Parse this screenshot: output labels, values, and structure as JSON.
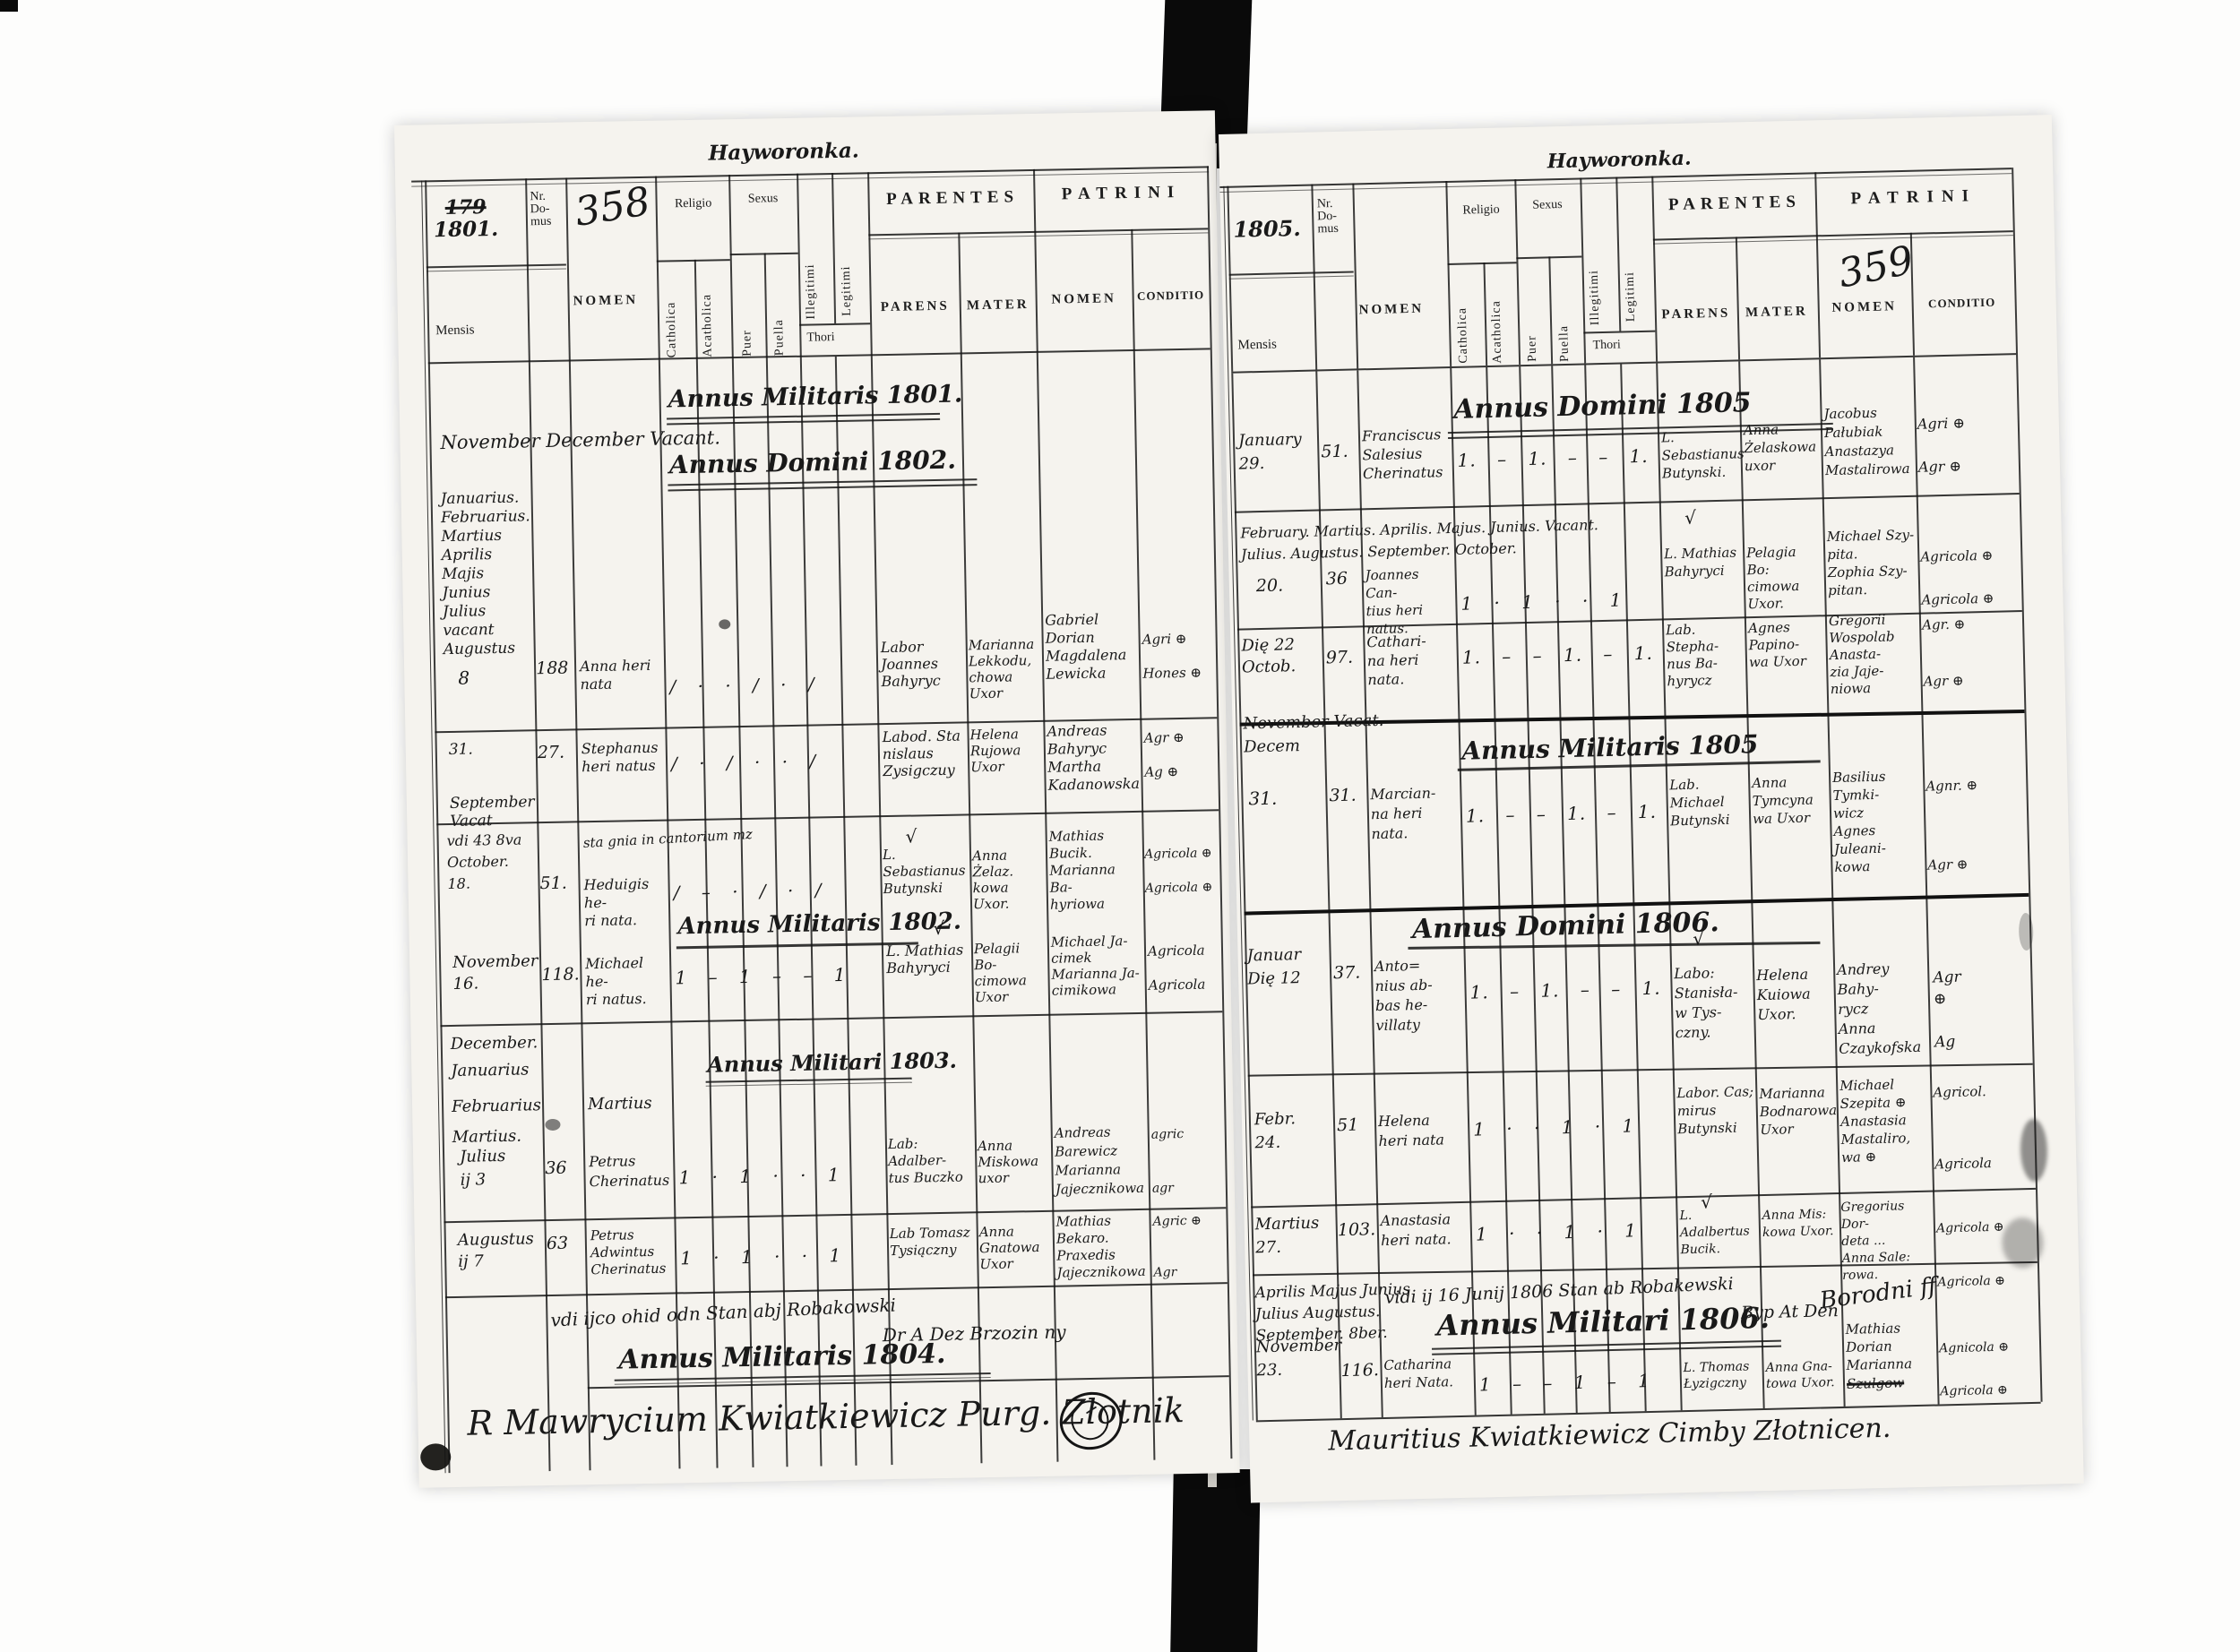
{
  "colors": {
    "ink": "#1c1c1c",
    "paper": "#f5f3ee",
    "spine": "#0a0a0a"
  },
  "marks": {
    "check": "√"
  },
  "left": {
    "title": "Hayworonka.",
    "header": {
      "year_struck": "179",
      "year": "1801.",
      "nr_domus": "Nr.\nDo-\nmus",
      "page_number": "358",
      "mensis": "Mensis",
      "nomen": "NOMEN",
      "religio": "Religio",
      "catholica": "Catholica",
      "acatholica": "Acatholica",
      "sexus": "Sexus",
      "puer": "Puer",
      "puella": "Puella",
      "illegitimi": "Illegitimi",
      "legitimi": "Legitimi",
      "thori": "Thori",
      "parentes": "PARENTES",
      "parens": "PARENS",
      "mater": "MATER",
      "patrini": "PATRINI",
      "patrini_nomen": "NOMEN",
      "conditio": "CONDITIO"
    },
    "headings": {
      "am1801": "Annus Militaris 1801.",
      "vacant": "November December Vacant.",
      "ad1802": "Annus Domini 1802.",
      "am1802": "Annus Militaris 1802.",
      "am1803": "Annus Militari 1803.",
      "am1804": "Annus Militaris 1804."
    },
    "months": "Januarius.\nFebruarius.\nMartius\nAprilis\nMajis\nJunius\nJulius\nvacant\nAugustus",
    "months2": "December.\nJanuarius",
    "months2b": "Februarius",
    "months2c": "Martius.",
    "martius_nomen": "Martius",
    "note": "vdi ijco ohid odn Stan abj Robakowski",
    "note2": "Dr A Dez Brzozin ny",
    "signature": "R   Mawrycium  Kwiatkiewicz   Purg.  Złotnik",
    "entries": [
      {
        "mensis": "8",
        "nr": "188",
        "nomen": "Anna heri\nnata",
        "ticks": "∕ · · ∕ · ∕",
        "parens": "Labor\nJoannes\nBahyryc",
        "mater": "Marianna\nLekkodu,\nchowa\nUxor",
        "patrini": "Gabriel\nDorian\nMagdalena\nLewicka",
        "conditio": "Agri ⊕\n\nHones ⊕"
      },
      {
        "mensis": "31.\n\n\nSeptember Vacat",
        "nr": "27.",
        "nomen": "Stephanus\nheri natus",
        "ticks": "∕ · ∕ · · ∕",
        "parens": "Labod. Sta\nnislaus\nZysigczuy",
        "mater": "Helena\nRujowa\nUxor",
        "patrini": "Andreas\nBahyryc\nMartha\nKadanowska",
        "conditio": "Agr ⊕\n\nAg ⊕"
      },
      {
        "mensis": "vdi 43 8va\nOctober.\n18.",
        "nr": "51.",
        "nomen": "Heduigis he-\nri nata.",
        "note": "sta gnia in cantorium mz",
        "ticks": "∕ – · ∕ · ∕",
        "parens": "L. Sebastianus\nButynski",
        "mater": "Anna Żelaz.\nkowa Uxor.",
        "patrini": "Mathias\nBucik.\nMarianna Ba-\nhyriowa",
        "conditio": "Agricola ⊕\n\nAgricola ⊕"
      },
      {
        "mensis": "November\n16.",
        "nr": "118.",
        "nomen": "Michael he-\nri natus.",
        "ticks": "1 – 1 – – 1",
        "parens": "L. Mathias\nBahyryci",
        "mater": "Pelagii Bo-\ncimowa Uxor",
        "patrini": "Michael Ja-\ncimek\nMarianna Ja-\ncimikowa",
        "conditio": "Agricola\n\nAgricola"
      },
      {
        "mensis": "Julius\nij 3",
        "nr": "36",
        "nomen": "Petrus\nCherinatus",
        "ticks": "1 · 1 · · 1",
        "parens": "Lab: Adalber-\ntus Buczko",
        "mater": "Anna\nMiskowa\nuxor",
        "patrini": "Andreas\nBarewicz\nMarianna\nJajecznikowa",
        "conditio": "agric\n\n\nagr"
      },
      {
        "mensis": "Augustus\nij 7",
        "nr": "63",
        "nomen": "Petrus\nAdwintus\nCherinatus",
        "ticks": "1 · 1 · · 1",
        "parens": "Lab Tomasz\nTysiączny",
        "mater": "Anna\nGnatowa\nUxor",
        "patrini": "Mathias\nBekaro.\nPraxedis\nJajecznikowa",
        "conditio": "Agric ⊕\n\n\nAgr"
      }
    ]
  },
  "right": {
    "title": "Hayworonka.",
    "header": {
      "year": "1805.",
      "nr_domus": "Nr.\nDo-\nmus",
      "page_number": "359",
      "mensis": "Mensis",
      "nomen": "NOMEN",
      "religio": "Religio",
      "catholica": "Catholica",
      "acatholica": "Acatholica",
      "sexus": "Sexus",
      "puer": "Puer",
      "puella": "Puella",
      "illegitimi": "Illegitimi",
      "legitimi": "Legitimi",
      "thori": "Thori",
      "parentes": "PARENTES",
      "parens": "PARENS",
      "mater": "MATER",
      "patrini": "PATRINI",
      "patrini_nomen": "NOMEN",
      "conditio": "CONDITIO"
    },
    "headings": {
      "ad1805": "Annus Domini 1805",
      "am1805": "Annus Militaris 1805",
      "ad1806": "Annus Domini 1806.",
      "am1806": "Annus Militari 1806."
    },
    "notes": {
      "mn1a": "February. Martius. Aprilis. Majus. Junius. Vacant.",
      "mn1b": "Julius. Augustus. September. October.",
      "mn2": "November Vacat.",
      "mn2b": "Decem",
      "mn3": "Aprilis Majus Junius\nJulius Augustus.\nSeptember. 8ber.",
      "note3": "vidi ij 16 Junij 1806 Stan ab Robakewski",
      "note3b": "Byp At Den",
      "note3c": "Borodni ff"
    },
    "signature": "Mauritius Kwiatkiewicz Cimby Złotnicen.",
    "entries": [
      {
        "mensis": "January\n29.",
        "nr": "51.",
        "nomen": "Franciscus\nSalesius\nCherinatus",
        "ticks": "1. – 1. – – 1.",
        "parens": "L. Sebastianus\nButynski.",
        "mater": "Anna\nŻelaskowa\nuxor",
        "patrini": "Jacobus\nPałubiak\nAnastazya\nMastalirowa",
        "conditio": "Agri ⊕\n\nAgr ⊕"
      },
      {
        "mensis": "20.",
        "nr": "36",
        "nomen": "Joannes Can-\ntius heri\nnatus.",
        "ticks": "1 · 1 · · 1",
        "parens": "L. Mathias\nBahyryci",
        "mater": "Pelagia Bo:\ncimowa Uxor.",
        "patrini": "Michael Szy-\npita.\nZophia Szy-\npitan.",
        "conditio": "Agricola ⊕\n\nAgricola ⊕"
      },
      {
        "mensis": "Dię 22\nOctob.",
        "nr": "97.",
        "nomen": "Cathari-\nna heri\nnata.",
        "ticks": "1. – – 1. – 1.",
        "parens": "Lab.\nStepha-\nnus Ba-\nhyrycz",
        "mater": "Agnes\nPapino-\nwa Uxor",
        "patrini": "Gregorii\nWospolab\nAnasta-\nzia Jaje-\nniowa",
        "conditio": "Agr. ⊕\n\n\nAgr ⊕"
      },
      {
        "mensis": "31.",
        "nr": "31.",
        "nomen": "Marcian-\nna heri\nnata.",
        "ticks": "1. – – 1. – 1.",
        "parens": "Lab.\nMichael\nButynski",
        "mater": "Anna\nTymcyna\nwa Uxor",
        "patrini": "Basilius\nTymki-\nwicz\nAgnes\nJuleani-\nkowa",
        "conditio": "Agnr. ⊕\n\n\n\nAgr ⊕"
      },
      {
        "mensis": "Januar\nDię 12",
        "nr": "37.",
        "nomen": "Anto=\nnius ab-\nbas he-\nvillaty",
        "ticks": "1. – 1. – – 1.",
        "parens": "Labo:\nStanisła-\nw Tys-\nczny.",
        "mater": "Helena\nKuiowa\nUxor.",
        "patrini": "Andrey\nBahy-\nrycz\nAnna\nCzaykofska",
        "conditio": "Agr\n⊕\n\nAg"
      },
      {
        "mensis": "Febr.\n24.",
        "nr": "51",
        "nomen": "Helena\nheri nata",
        "ticks": "1 · · 1 · 1",
        "parens": "Labor. Cas;\nmirus\nButynski",
        "mater": "Marianna\nBodnarowa\nUxor",
        "patrini": "Michael\nSzepita ⊕\nAnastasia\nMastaliro,\nwa ⊕",
        "conditio": "Agricol.\n\n\n\nAgricola"
      },
      {
        "mensis": "Martius\n27.",
        "nr": "103.",
        "nomen": "Anastasia\nheri nata.",
        "ticks": "1 · · 1 · 1",
        "parens": "L. Adalbertus\nBucik.",
        "mater": "Anna Mis:\nkowa Uxor.",
        "patrini": "Gregorius Dor-\ndeta ...\nAnna Sale:\nrowa.",
        "conditio": "Agricola ⊕\n\nAgricola ⊕"
      },
      {
        "mensis": "November\n23.",
        "nr": "116.",
        "nomen": "Catharina\nheri Nata.",
        "ticks": "1 – – 1 – 1",
        "parens": "L. Thomas\nŁyzigczny",
        "mater": "Anna Gna-\ntowa Uxor.",
        "patrini": "Mathias\nDorian\nMarianna",
        "patrini2": "Szulgow",
        "conditio": "Agnicola ⊕\n\nAgricola ⊕"
      }
    ]
  }
}
